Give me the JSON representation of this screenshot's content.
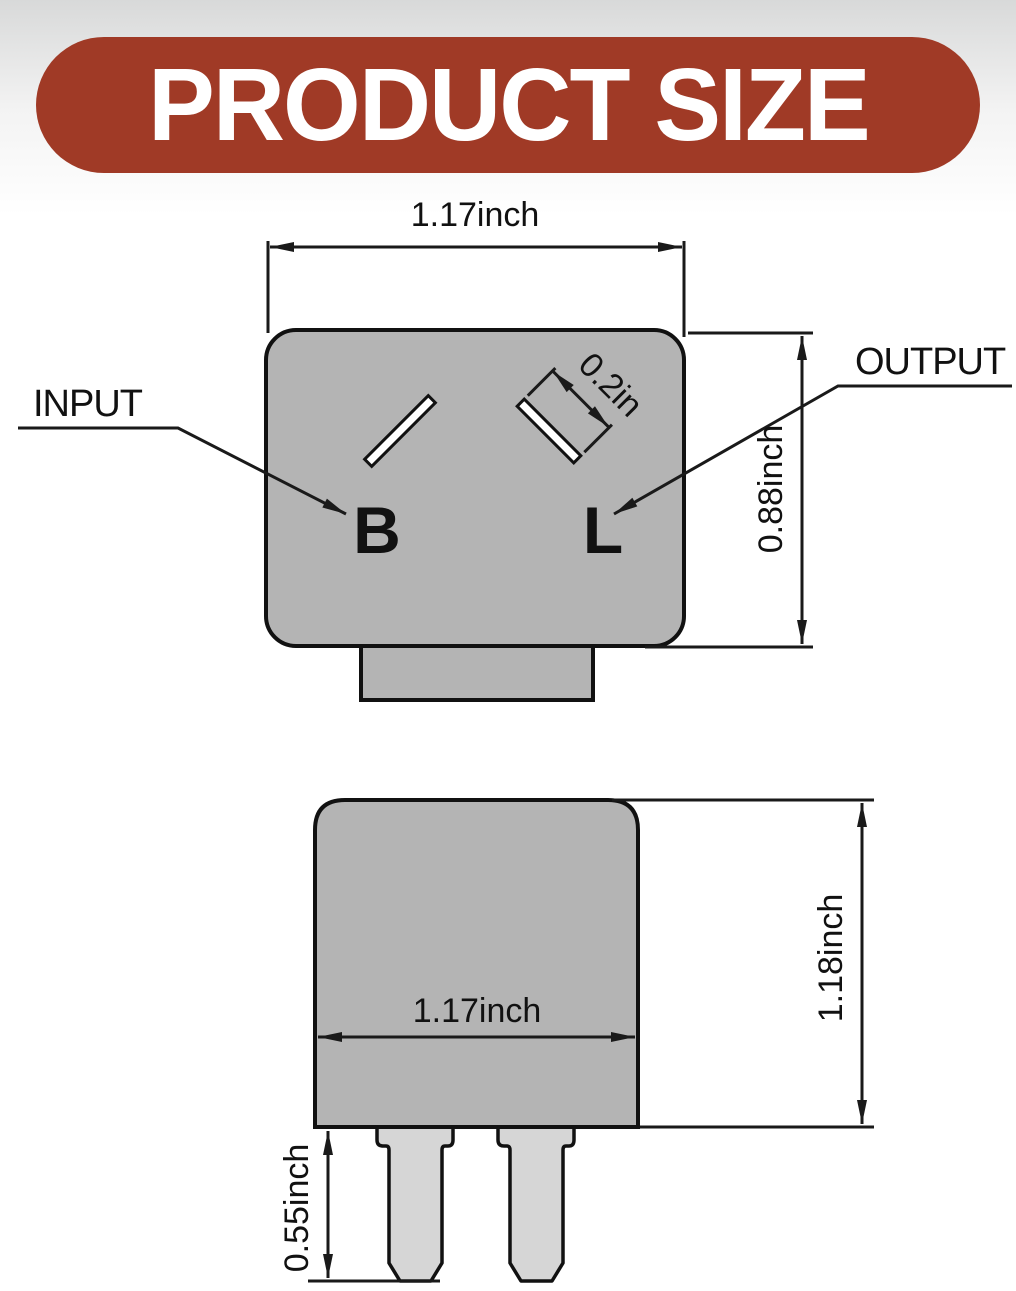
{
  "banner": {
    "title": "PRODUCT SIZE",
    "bg_color": "#a03a26",
    "text_color": "#ffffff"
  },
  "colors": {
    "device_body_gray": "#b4b4b4",
    "prong_gray": "#d6d6d6",
    "line_color": "#1a1a1a",
    "background_top_gray": "#d8d9d9"
  },
  "top_view": {
    "width_label": "1.17inch",
    "height_label": "0.88inch",
    "slot_width_label": "0.2in",
    "input_label": "INPUT",
    "output_label": "OUTPUT",
    "terminal_b": "B",
    "terminal_l": "L"
  },
  "side_view": {
    "width_label": "1.17inch",
    "height_label": "1.18inch",
    "pin_length_label": "0.55inch"
  }
}
